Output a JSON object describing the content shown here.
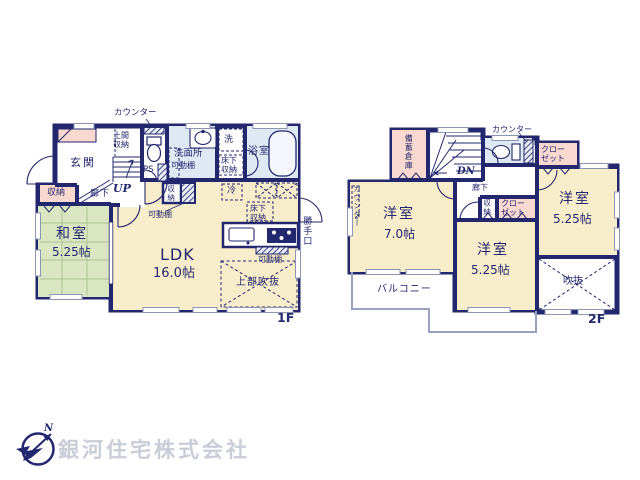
{
  "document": {
    "type": "floor-plan",
    "floors": [
      "1F",
      "2F"
    ]
  },
  "colors": {
    "wall_navy": "#23276e",
    "room_cream": "#f8edca",
    "tatami_green": "#d9e6c1",
    "closet_pink": "#f9d8d0",
    "wet_area_blue": "#dfe9f4",
    "balcony_line_gray": "#98a2c0",
    "logo_text_gray": "#c9cdd8"
  },
  "floor1": {
    "floor_label": "1F",
    "labels": {
      "counter_top": "カウンター",
      "entrance": "玄関",
      "doma_storage": "土間収納",
      "pipe_space": "PS",
      "stairs_up": "UP",
      "washroom": "洗面所",
      "movable_shelf_washroom": "可動棚",
      "laundry": "洗",
      "underfloor_storage_washroom": "床下収納",
      "bathroom": "浴室",
      "hallway": "廊下",
      "storage_hall": "収納",
      "tatami_room": "和室",
      "tatami_room_size": "5.25帖",
      "ldk": "LDK",
      "ldk_size": "16.0帖",
      "storage_ldk": "収納",
      "movable_shelf_ldk": "可動棚",
      "refrigerator": "冷",
      "underfloor_storage_kitchen": "床下収納",
      "movable_shelf_kitchen": "可動棚",
      "back_door": "勝手口",
      "open_ceiling_above": "上部吹抜"
    }
  },
  "floor2": {
    "floor_label": "2F",
    "labels": {
      "stock_storage": "備蓄倉庫",
      "stairs_down": "DN",
      "counter_top": "カウンター",
      "closet_north": "クローゼット",
      "hallway": "廊下",
      "storage_hall": "収納",
      "closet_center": "クローゼット",
      "counter_west": "カウンター",
      "bedroom_west": "洋室",
      "bedroom_west_size": "7.0帖",
      "bedroom_center": "洋室",
      "bedroom_center_size": "5.25帖",
      "bedroom_east": "洋室",
      "bedroom_east_size": "5.25帖",
      "balcony": "バルコニー",
      "open_ceiling": "吹抜"
    }
  },
  "footer": {
    "company_name": "銀河住宅株式会社",
    "compass_north": "N"
  }
}
